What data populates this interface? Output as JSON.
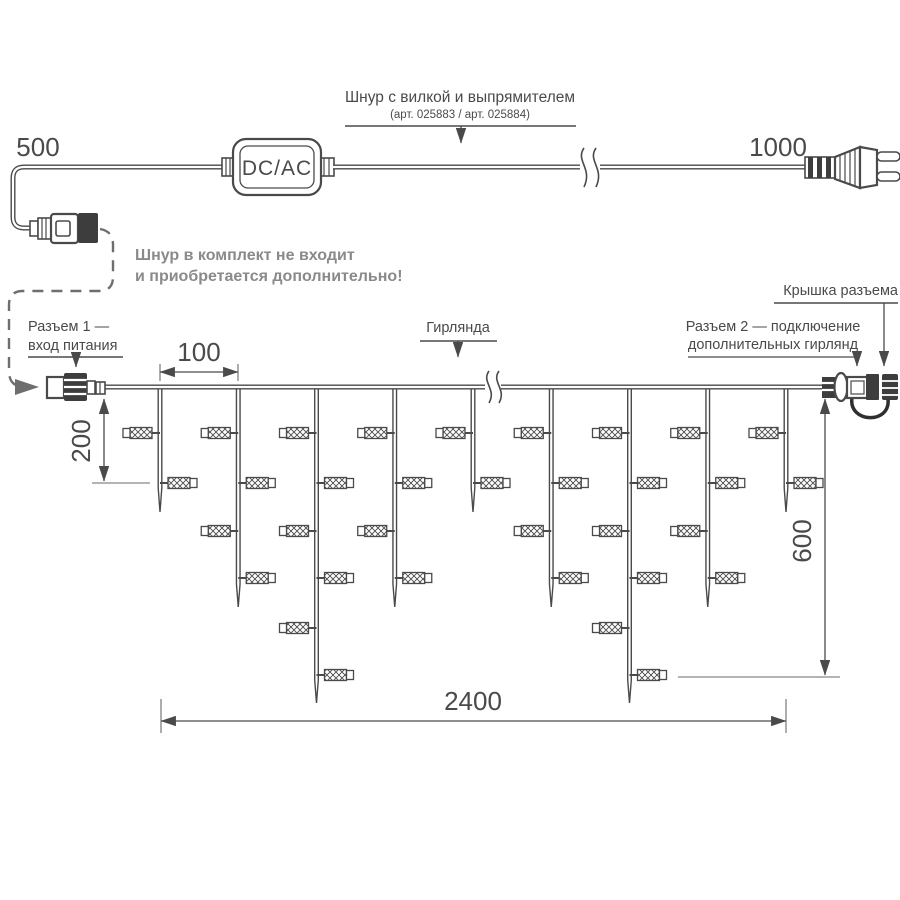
{
  "cord": {
    "title": "Шнур с вилкой и выпрямителем",
    "subtitle": "(арт. 025883 / арт. 025884)",
    "adapter": "DC/AC",
    "dim_left": "500",
    "dim_right": "1000"
  },
  "note": {
    "line1": "Шнур в комплект не входит",
    "line2": "и приобретается дополнительно!"
  },
  "garland": {
    "connector1_line1": "Разъем 1 —",
    "connector1_line2": "вход питания",
    "garland_label": "Гирлянда",
    "cap_label": "Крышка разъема",
    "connector2_line1": "Разъем 2 — подключение",
    "connector2_line2": "дополнительных гирлянд",
    "dims": {
      "spacing": "100",
      "first_drop": "200",
      "height": "600",
      "length": "2400"
    },
    "drop_pattern": [
      "short",
      "medium",
      "long",
      "medium",
      "short",
      "medium",
      "long",
      "medium",
      "short"
    ]
  },
  "colors": {
    "line": "#4a4a4a",
    "note_text": "#8a8a8a",
    "background": "#ffffff"
  }
}
